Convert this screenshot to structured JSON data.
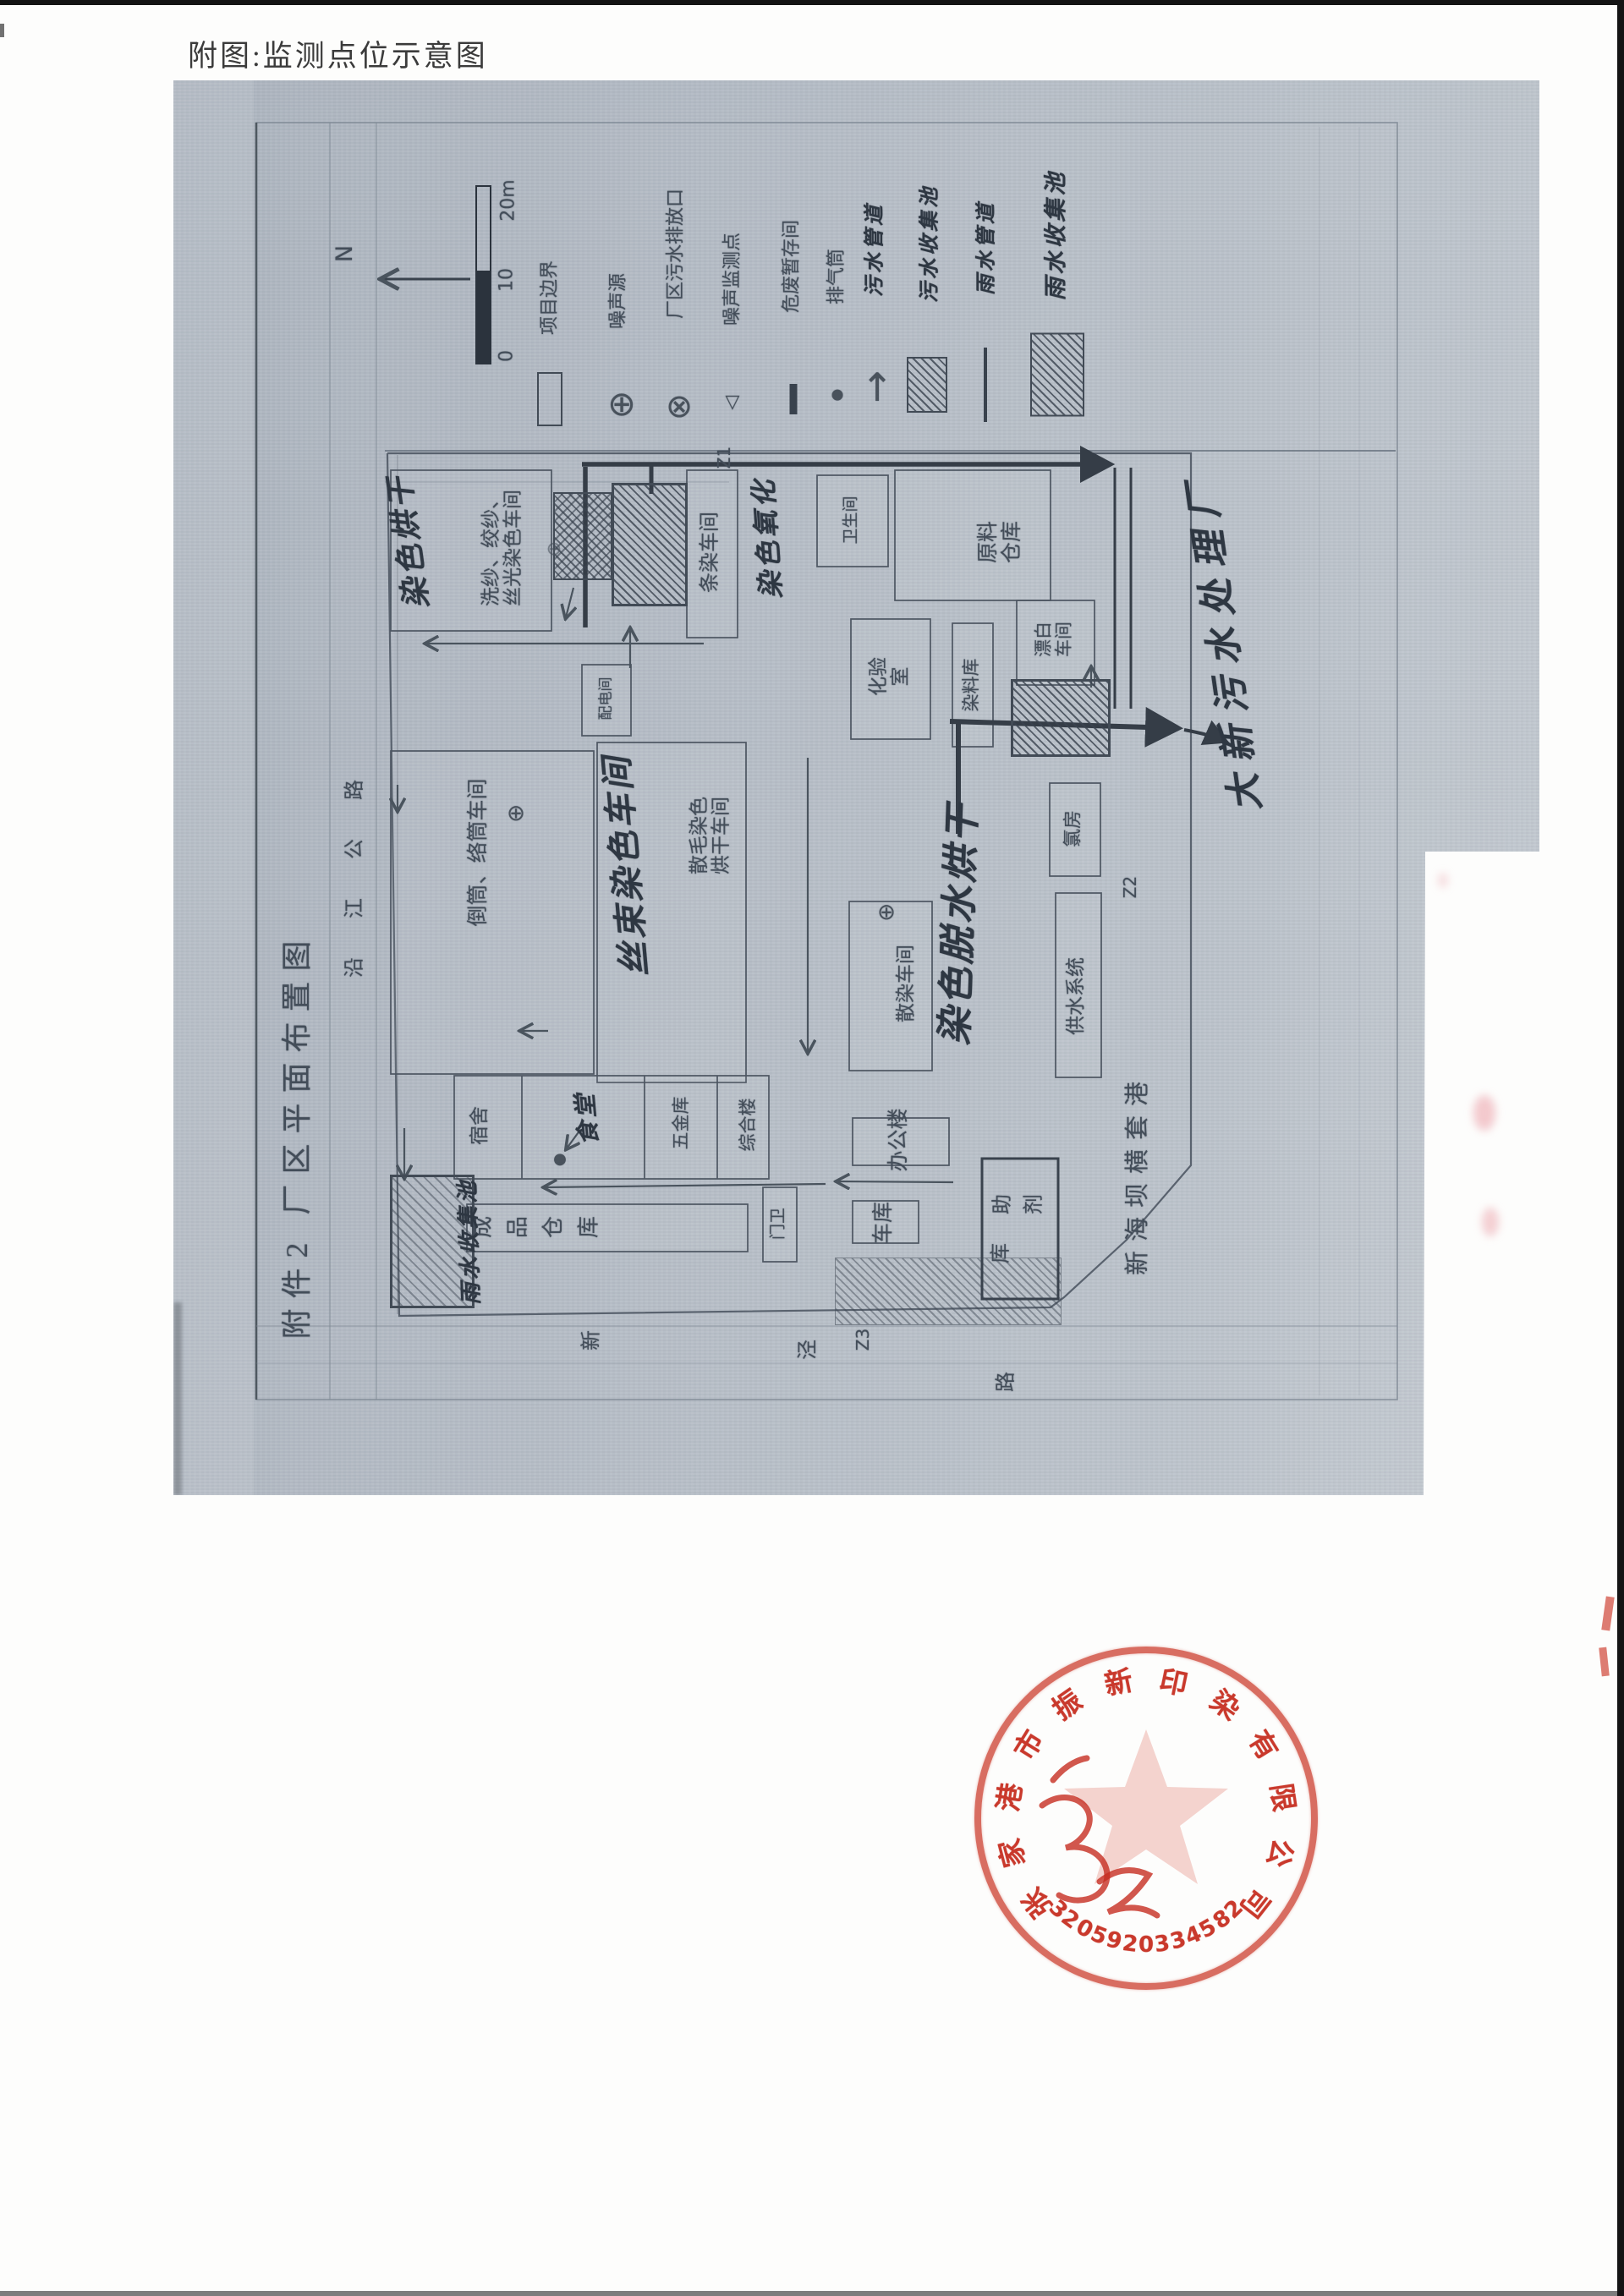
{
  "page": {
    "title": "附图:监测点位示意图"
  },
  "map": {
    "attachment_title": "附件2 厂区平面布置图",
    "north_label": "N",
    "scale_labels": [
      "0",
      "10",
      "20m"
    ],
    "legend": [
      {
        "id": "project-boundary",
        "label": "项目边界",
        "symbol": "rect-outline-icon"
      },
      {
        "id": "noise-source",
        "label": "噪声源",
        "symbol": "circle-plus-icon"
      },
      {
        "id": "sewage-outfall",
        "label": "厂区污水排放口",
        "symbol": "circle-x-icon"
      },
      {
        "id": "noise-monitor",
        "label": "噪声监测点",
        "symbol": "triangle-icon"
      },
      {
        "id": "hazwaste-room",
        "label": "危废暂存间",
        "symbol": "thick-dash-icon"
      },
      {
        "id": "exhaust-stack",
        "label": "排气筒",
        "symbol": "dot-icon"
      },
      {
        "id": "sewage-pipe",
        "label": "污水管道",
        "symbol": "arrow-up-icon",
        "handwritten": true
      },
      {
        "id": "sewage-pool",
        "label": "污水收集池",
        "symbol": "hatched-rect-icon",
        "handwritten": true
      },
      {
        "id": "rain-pipe",
        "label": "雨水管道",
        "symbol": "line-icon",
        "handwritten": true
      },
      {
        "id": "rain-pool",
        "label": "雨水收集池",
        "symbol": "hatched-rect-large-icon",
        "handwritten": true
      }
    ],
    "labels": [
      {
        "id": "xisha",
        "text": "洗纱、绞纱、丝光染色车间",
        "lines": [
          "洗纱、绞纱、",
          "丝光染色车间"
        ],
        "kind": "printed"
      },
      {
        "id": "tiaoran",
        "text": "条染车间",
        "kind": "printed"
      },
      {
        "id": "weishengjian",
        "text": "卫生间",
        "kind": "printed"
      },
      {
        "id": "yuanliao",
        "text": "原料仓库",
        "lines": [
          "原料",
          "仓库"
        ],
        "kind": "printed"
      },
      {
        "id": "peidian",
        "text": "配电间",
        "kind": "printed"
      },
      {
        "id": "huayan",
        "text": "化验室",
        "lines": [
          "化验",
          "室"
        ],
        "kind": "printed"
      },
      {
        "id": "ranliaoku",
        "text": "染料库",
        "kind": "printed"
      },
      {
        "id": "piaobai",
        "text": "漂白车间",
        "lines": [
          "漂白",
          "车间"
        ],
        "kind": "printed"
      },
      {
        "id": "daotong",
        "text": "倒筒、络筒车间",
        "kind": "printed"
      },
      {
        "id": "sanmao",
        "text": "散毛染色烘干车间",
        "lines": [
          "散毛染色",
          "烘干车间"
        ],
        "kind": "printed"
      },
      {
        "id": "sanran",
        "text": "散染车间",
        "kind": "printed"
      },
      {
        "id": "lvfang",
        "text": "氯房",
        "kind": "printed"
      },
      {
        "id": "gongshui",
        "text": "供水系统",
        "kind": "printed"
      },
      {
        "id": "sushe",
        "text": "宿舍",
        "kind": "printed"
      },
      {
        "id": "wujinku",
        "text": "五金库",
        "kind": "printed"
      },
      {
        "id": "zonghelou",
        "text": "综合楼",
        "kind": "printed"
      },
      {
        "id": "bangonglou",
        "text": "办公楼",
        "kind": "printed"
      },
      {
        "id": "cheku",
        "text": "车库",
        "kind": "printed"
      },
      {
        "id": "menwei",
        "text": "门卫",
        "kind": "printed"
      },
      {
        "id": "chengpin",
        "text": "成品仓库",
        "kind": "perchar"
      },
      {
        "id": "zhujiku",
        "text": "助剂库",
        "kind": "perchar"
      },
      {
        "id": "ranse-honggan",
        "text": "染色烘干",
        "kind": "handwritten"
      },
      {
        "id": "ranse-yanghua",
        "text": "染色氧化",
        "kind": "handwritten"
      },
      {
        "id": "sishu",
        "text": "丝束染色车间",
        "kind": "handwritten"
      },
      {
        "id": "ranse-tuoshui",
        "text": "染色脱水烘干",
        "kind": "handwritten"
      },
      {
        "id": "yushui-box",
        "text": "雨水收集池",
        "kind": "handwritten"
      },
      {
        "id": "shitang",
        "text": "食堂",
        "kind": "handwritten"
      },
      {
        "id": "daxin",
        "text": "大新污水处理厂",
        "kind": "handwritten"
      },
      {
        "id": "z1",
        "text": "Z1",
        "kind": "mark"
      },
      {
        "id": "z2",
        "text": "Z2",
        "kind": "mark"
      },
      {
        "id": "z3",
        "text": "Z3",
        "kind": "mark"
      }
    ],
    "roads": {
      "left": "沿江公路",
      "bottom": "新泾路",
      "waterway": "新海坝横套港"
    },
    "monitoring_points": [
      "Z1",
      "Z2",
      "Z3"
    ]
  },
  "stamp": {
    "company": "张家港市振新印染有限公司",
    "serial": "3205920334582"
  }
}
